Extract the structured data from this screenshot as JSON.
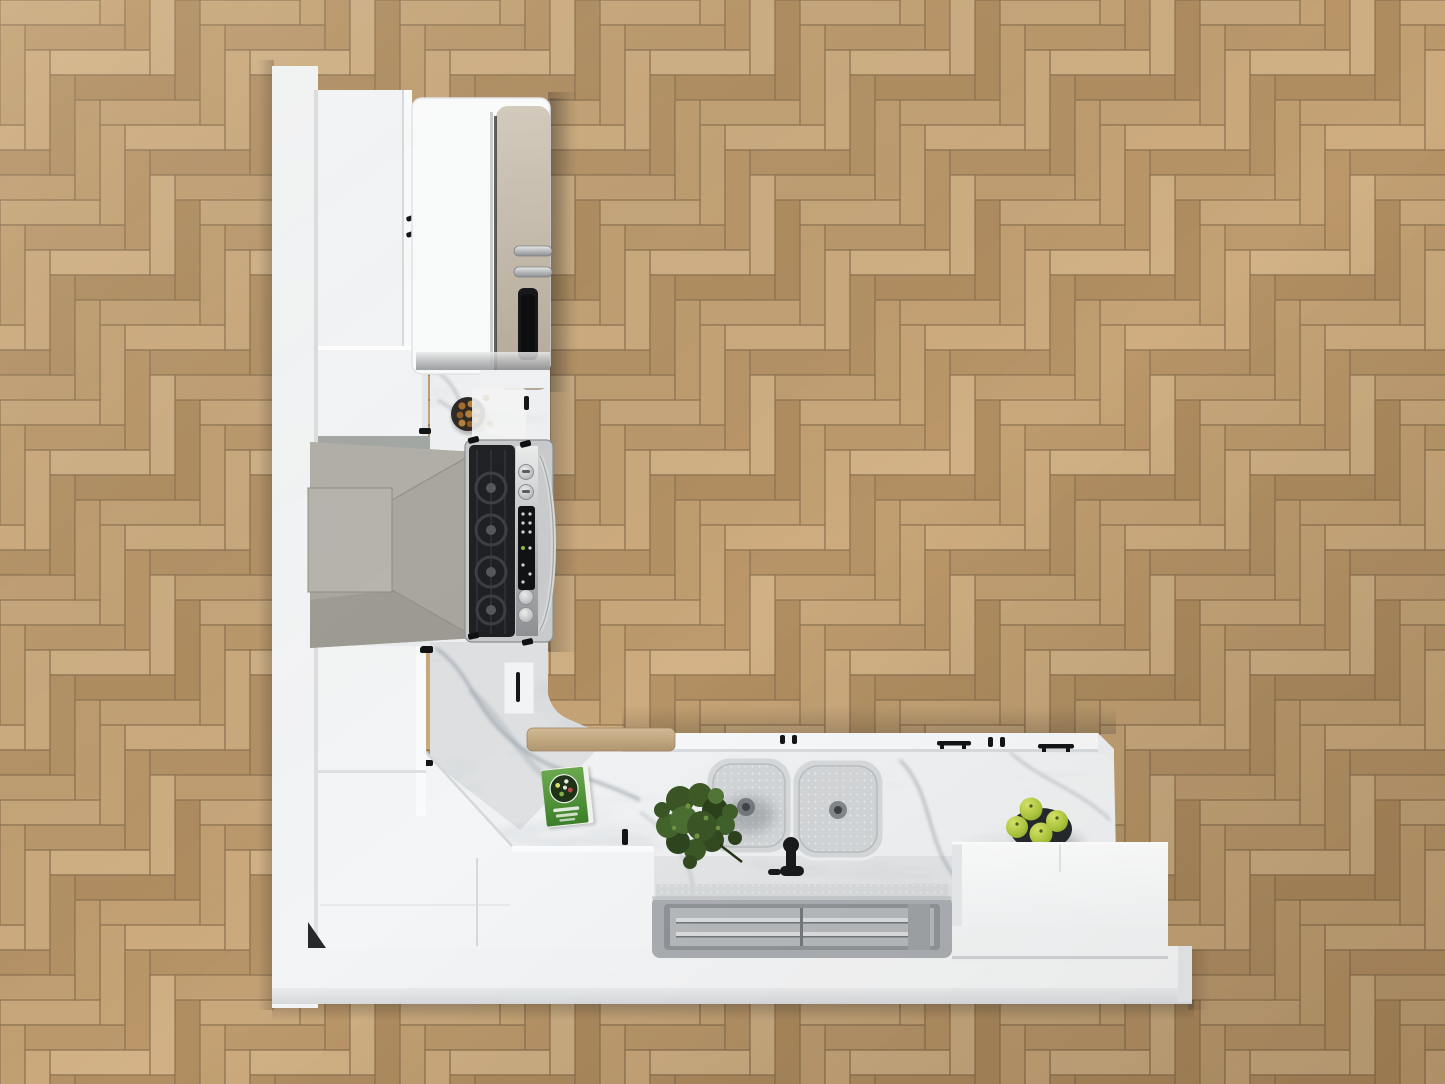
{
  "scene": {
    "description": "Top-down 3D render of an L-shaped white kitchen on a herringbone oak floor",
    "view": "top-down",
    "room_type": "kitchen"
  },
  "palette": {
    "floor_plank": "#c2a176",
    "floor_seam": "#8f7452",
    "platform": "#f3f4f5",
    "cabinet_white": "#f3f5f6",
    "marble": "#eff1f2",
    "marble_vein": "#9fa6ad",
    "hood": "#a9a79f",
    "stainless": "#c9cbcd",
    "cooktop": "#1f2124",
    "fridge_door": "#cbc1b2",
    "sink": "#d6d9db",
    "tray_frame": "#a9adb1",
    "tray_glass": "#b4b8bb",
    "plant": "#3a5526",
    "apple_bowl": "#24292d",
    "book_cover": "#4f9138",
    "cutting_board": "#c7ae89",
    "nut_bowl": "#2e2a26",
    "handle_black": "#121416"
  },
  "objects": {
    "inventory": [
      "herringbone-wood-floor",
      "white-wall-band",
      "white-floor-platform",
      "tall-cabinet",
      "upper-cabinet",
      "fridge",
      "range-hood",
      "range-stove",
      "nut-bowl",
      "marble-countertop",
      "corner-cabinet",
      "cookbook",
      "double-sink",
      "faucet",
      "potted-plant",
      "cutting-board",
      "apple-bowl",
      "island-box",
      "glass-tray-inset",
      "base-cabinet-doors"
    ]
  }
}
